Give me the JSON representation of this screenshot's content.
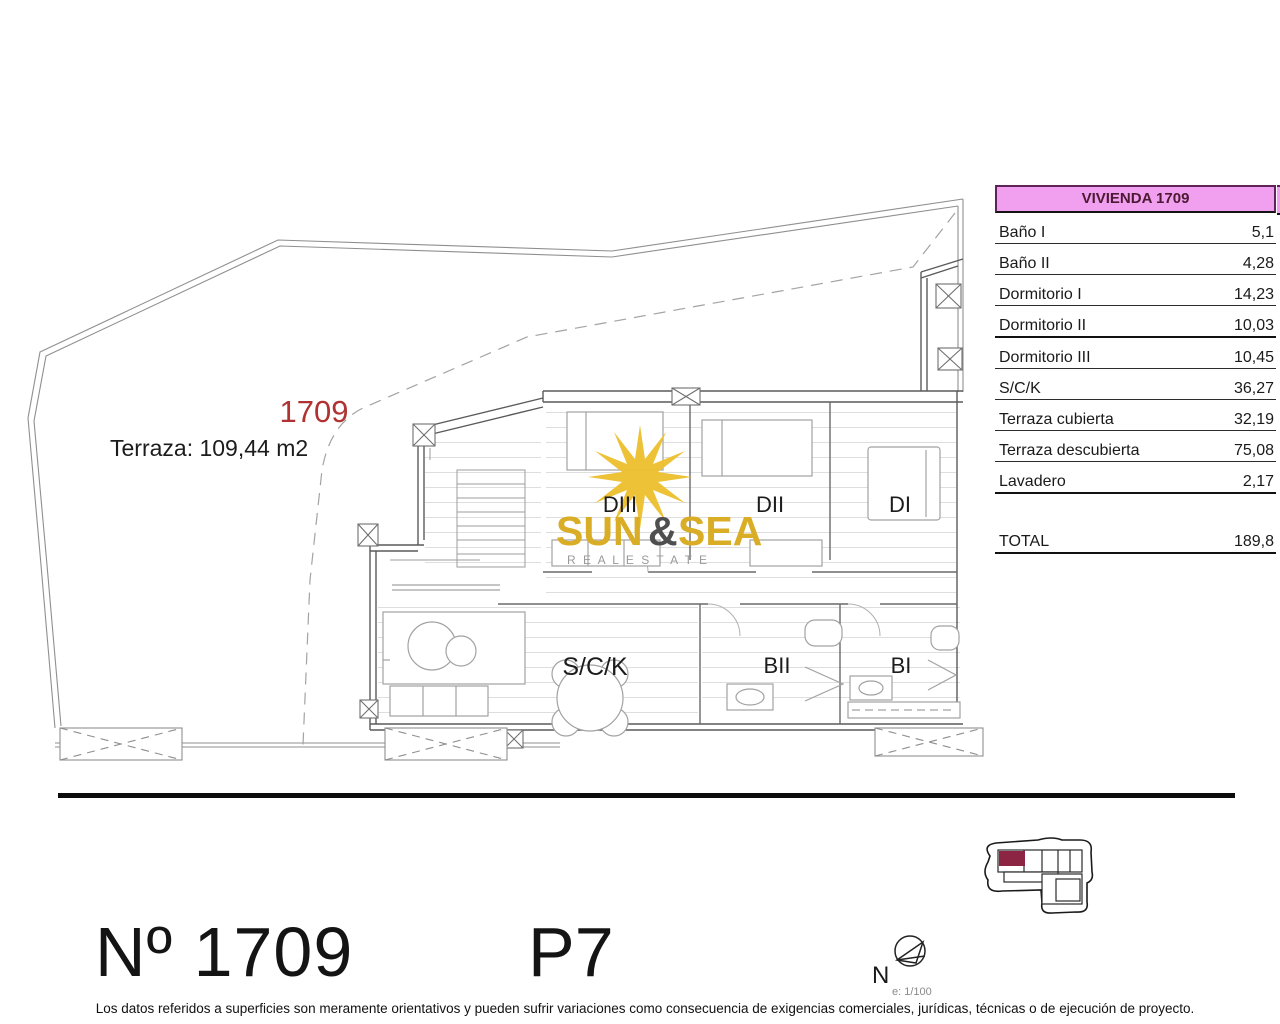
{
  "plan": {
    "unit_label": "1709",
    "terrace_note": "Terraza: 109,44 m2",
    "rooms": {
      "dormitorio3": "DIII",
      "dormitorio2": "DII",
      "dormitorio1": "DI",
      "salon_cocina": "S/C/K",
      "bano2": "BII",
      "bano1": "BI"
    }
  },
  "logo": {
    "word1": "SUN",
    "ampersand": "&",
    "word2": "SEA",
    "subtitle": "R E A L   E S T A T E"
  },
  "table": {
    "header": "VIVIENDA 1709",
    "rows": [
      {
        "label": "Baño I",
        "value": "5,1",
        "heavy": false
      },
      {
        "label": "Baño II",
        "value": "4,28",
        "heavy": false
      },
      {
        "label": "Dormitorio I",
        "value": "14,23",
        "heavy": false
      },
      {
        "label": "Dormitorio II",
        "value": "10,03",
        "heavy": true
      },
      {
        "label": "Dormitorio III",
        "value": "10,45",
        "heavy": false
      },
      {
        "label": "S/C/K",
        "value": "36,27",
        "heavy": false
      },
      {
        "label": "Terraza cubierta",
        "value": "32,19",
        "heavy": false
      },
      {
        "label": "Terraza descubierta",
        "value": "75,08",
        "heavy": false
      },
      {
        "label": "Lavadero",
        "value": "2,17",
        "heavy": true
      }
    ],
    "total_label": "TOTAL",
    "total_value": "189,8"
  },
  "footer": {
    "unit_number": "Nº 1709",
    "floor": "P7",
    "north_label": "N",
    "scale": "e: 1/100",
    "disclaimer": "Los datos referidos a superficies son meramente orientativos y pueden sufrir variaciones como consecuencia de exigencias comerciales, jurídicas, técnicas o de ejecución de proyecto."
  },
  "colors": {
    "table_header_bg": "#f0a0ee",
    "unit_red": "#b03232",
    "logo_gold": "#d9ad25",
    "key_unit_maroon": "#8c2444"
  }
}
